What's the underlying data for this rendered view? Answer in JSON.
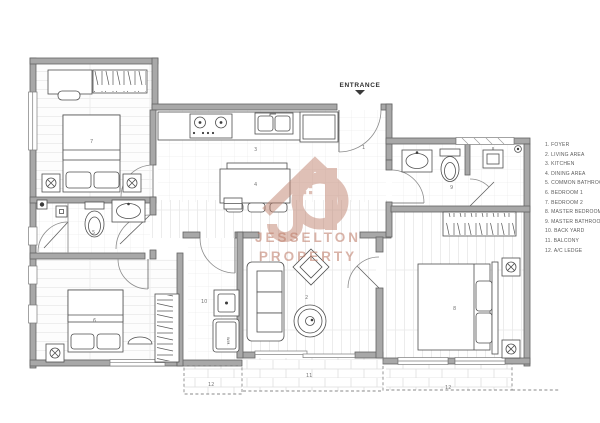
{
  "plan": {
    "entrance": {
      "label": "ENTRANCE"
    },
    "watermark": {
      "line1": "JESSELTON",
      "line2": "PROPERTY"
    },
    "room_numbers": {
      "foyer": "1",
      "living": "2",
      "kitchen": "3",
      "dining": "4",
      "common_bath": "5",
      "bedroom1": "6",
      "bedroom2": "7",
      "master_bedroom": "8",
      "master_bath": "9",
      "back_yard": "10",
      "balcony": "11",
      "ac_ledge_left": "12",
      "ac_ledge_right": "12"
    },
    "labels": {
      "washing_machine": "W.M."
    }
  },
  "legend": {
    "items": [
      "1. FOYER",
      "2. LIVING AREA",
      "3. KITCHEN",
      "4. DINING AREA",
      "5. COMMON BATHROOM",
      "6. BEDROOM 1",
      "7. BEDROOM 2",
      "8. MASTER BEDROOM",
      "9. MASTER BATHROOM",
      "10. BACK YARD",
      "11. BALCONY",
      "12. A/C LEDGE"
    ]
  },
  "colors": {
    "wall": "#a8a8a8",
    "wall_stroke": "#636363",
    "accent": "#c0826f",
    "furniture_line": "#4f4f4f"
  }
}
